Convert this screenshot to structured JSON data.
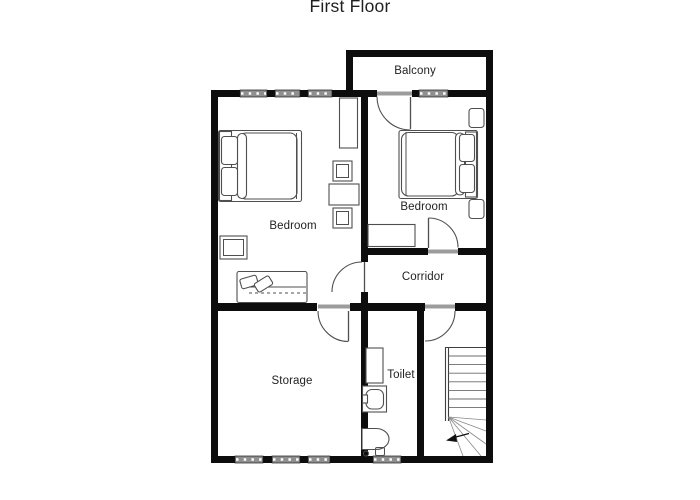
{
  "title": "First Floor",
  "rooms": {
    "balcony": {
      "label": "Balcony"
    },
    "bedroom_left": {
      "label": "Bedroom"
    },
    "bedroom_right": {
      "label": "Bedroom"
    },
    "corridor": {
      "label": "Corridor"
    },
    "storage": {
      "label": "Storage"
    },
    "toilet": {
      "label": "Toilet"
    }
  },
  "colors": {
    "wall": "#0d0d0d",
    "line": "#4f4f4f",
    "window_fill": "#8f8f8f",
    "threshold": "#9c9c9c",
    "text": "#1f1f1f",
    "bg": "#ffffff"
  }
}
